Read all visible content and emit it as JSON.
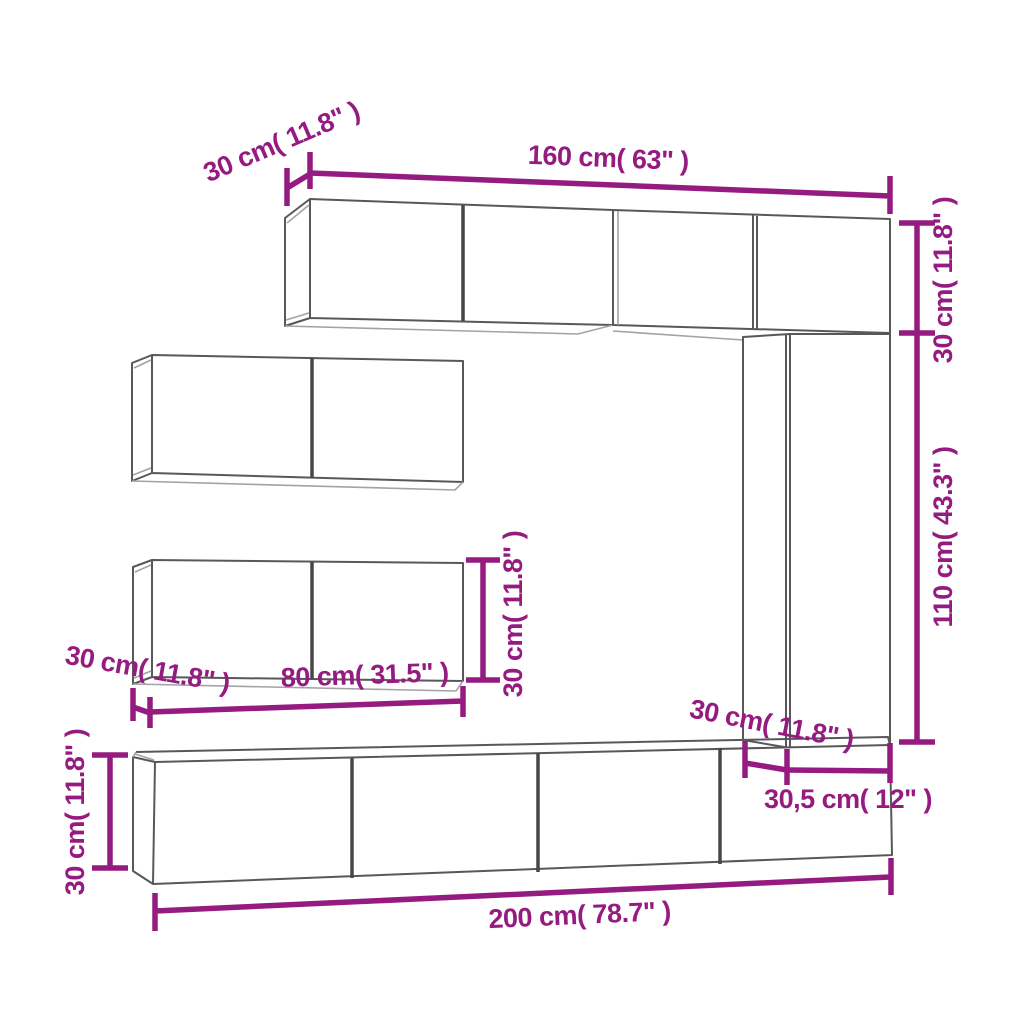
{
  "diagram": {
    "type": "furniture-dimension-diagram",
    "colors": {
      "accent": "#951B81",
      "line_dark": "#58585a",
      "line_div": "#47474a",
      "line_light": "#a3a3a5",
      "bg": "#ffffff"
    },
    "dimensions": {
      "top_depth": "30 cm( 11.8\" )",
      "top_width": "160 cm( 63\" )",
      "right_top_height": "30 cm( 11.8\" )",
      "right_height": "110 cm( 43.3\" )",
      "middle_height": "30 cm( 11.8\" )",
      "middle_depth": "30 cm( 11.8\" )",
      "middle_width": "80 cm( 31.5\" )",
      "bottom_height": "30 cm( 11.8\" )",
      "bottom_right_depth": "30 cm( 11.8\" )",
      "bottom_right_width": "30,5 cm( 12\" )",
      "bottom_width": "200 cm( 78.7\" )"
    }
  }
}
